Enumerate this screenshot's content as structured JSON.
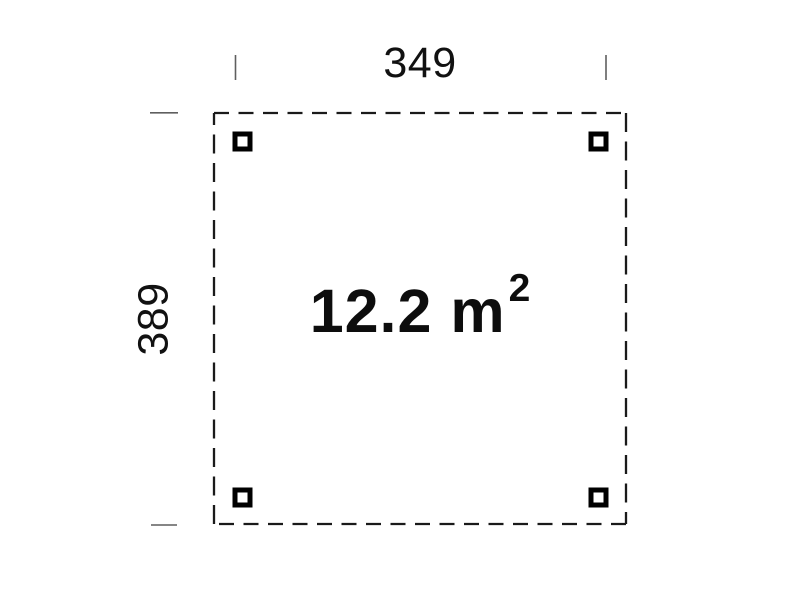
{
  "plan": {
    "area": {
      "text": "12.2 m",
      "exponent": "2"
    },
    "dimensions": {
      "width_label": "349",
      "height_label": "389"
    },
    "posts": {
      "count": 4,
      "positions": [
        "top-left",
        "top-right",
        "bottom-left",
        "bottom-right"
      ]
    },
    "colors": {
      "outline": "#1a1a1a",
      "post": "#000000",
      "post_fill": "#ffffff",
      "tick": "#5f5f5f",
      "text": "#111111",
      "background": "#ffffff"
    }
  }
}
